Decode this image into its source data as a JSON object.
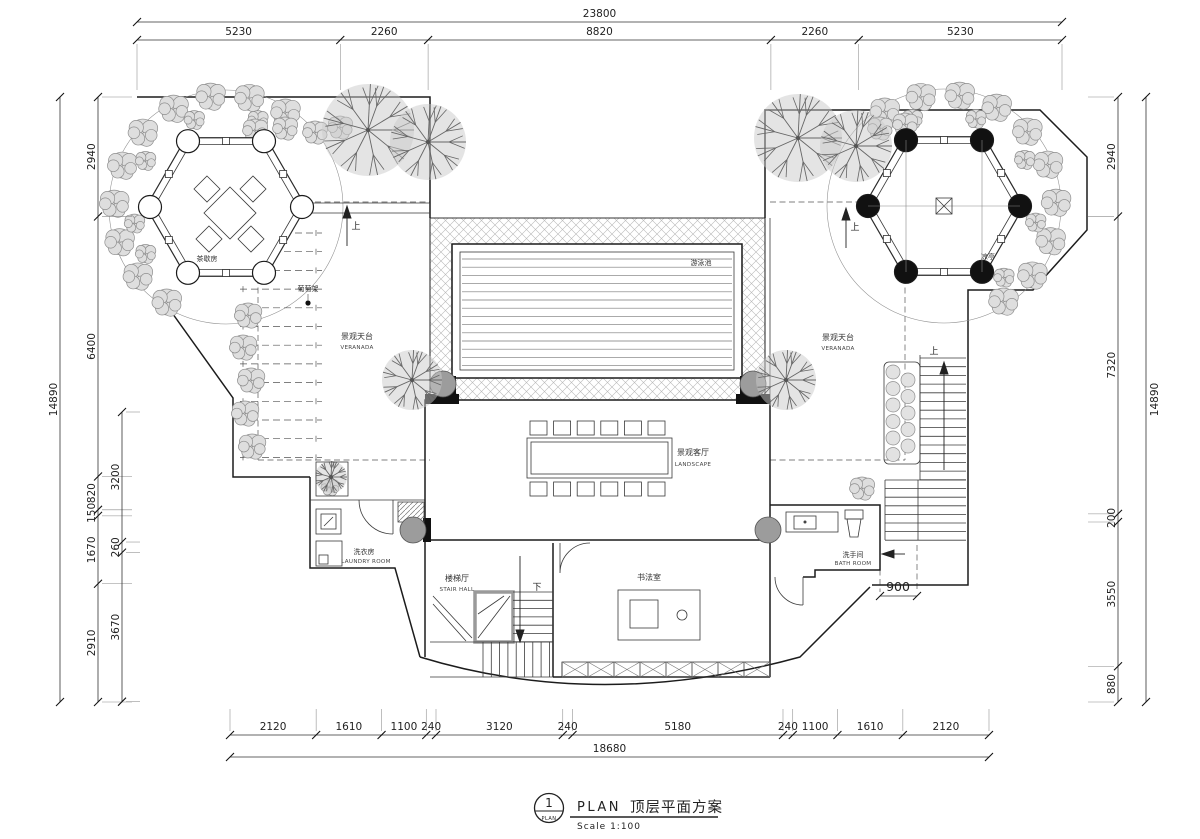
{
  "drawing": {
    "title_block": {
      "detail_number": "1",
      "detail_marker_label": "PLAN",
      "name_en": "PLAN",
      "name_cn": "顶层平面方案",
      "scale": "Scale 1:100"
    },
    "labels": {
      "tea_room_cn": "茶歇房",
      "pavilion_cn": "凉亭",
      "grape_trellis_cn": "葡萄架",
      "veranda_left_cn": "景观天台",
      "veranda_left_en": "VERANADA",
      "veranda_right_cn": "景观天台",
      "veranda_right_en": "VERANADA",
      "pool_cn": "游泳池",
      "living_cn": "景观客厅",
      "living_en": "LANDSCAPE",
      "laundry_cn": "洗衣房",
      "laundry_en": "LAUNDRY ROOM",
      "stair_hall_cn": "楼梯厅",
      "stair_hall_en": "STAIR HALL",
      "calligraphy_cn": "书法室",
      "bath_cn": "洗手间",
      "bath_en": "BATH ROOM",
      "up": "上",
      "down": "下",
      "stair_width": "900"
    },
    "dimensions": {
      "top": {
        "total": "23800",
        "segments": [
          "5230",
          "2260",
          "8820",
          "2260",
          "5230"
        ]
      },
      "bottom": {
        "total": "18680",
        "segments": [
          "2120",
          "1610",
          "1100",
          "240",
          "3120",
          "240",
          "5180",
          "240",
          "1100",
          "1610",
          "2120"
        ]
      },
      "left": {
        "total": "14890",
        "outer_segments": [
          "2940",
          "6400",
          "820",
          "150",
          "1670",
          "2910"
        ],
        "inner_segments": [
          "3200",
          "260",
          "3670"
        ]
      },
      "right": {
        "total": "14890",
        "segments": [
          "2940",
          "7320",
          "200",
          "3550",
          "880"
        ]
      }
    }
  }
}
